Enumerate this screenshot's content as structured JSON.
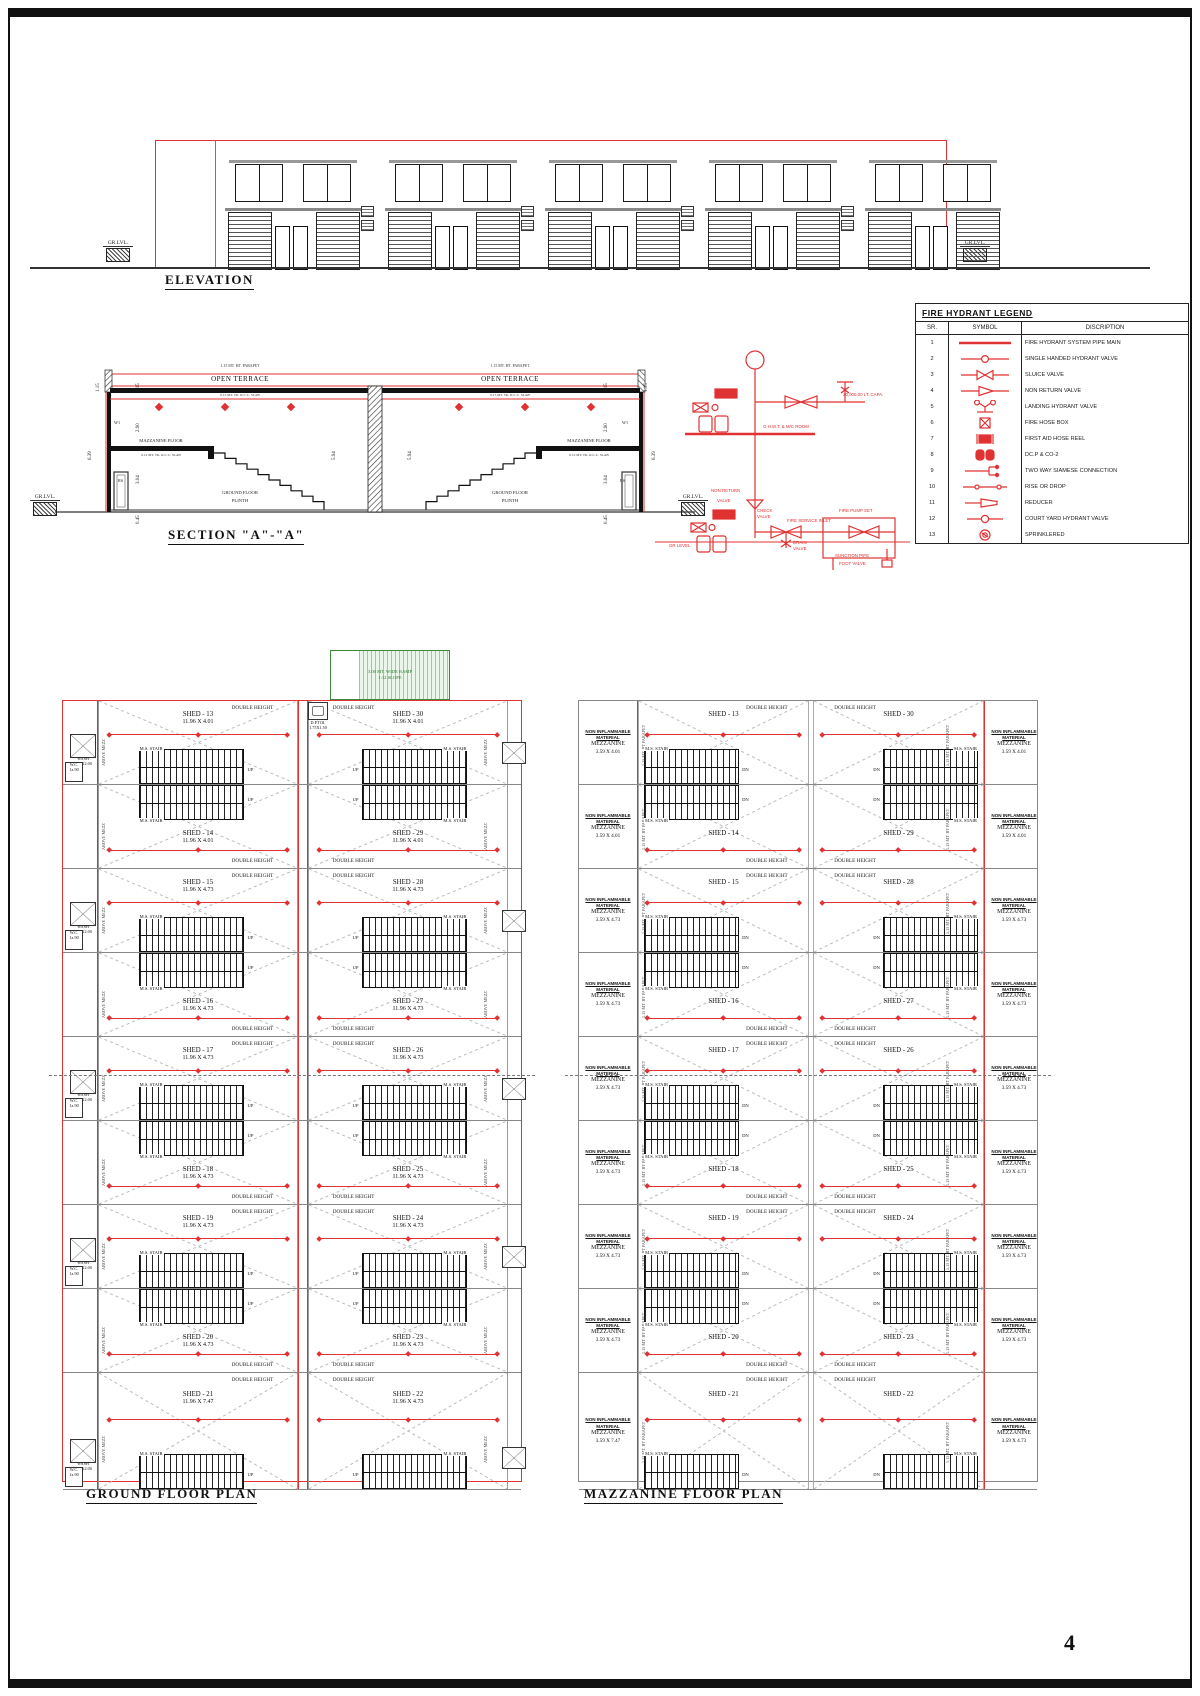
{
  "page": {
    "number": "4"
  },
  "labels": {
    "double_height": "DOUBLE HEIGHT",
    "ms_stair": "M.S. STAIR",
    "up": "UP",
    "dn": "DN",
    "above_mezz": "ABOVE MEZZ",
    "wc": "W.C.\n1x.90",
    "wash": "WASH\n2.00X2.00",
    "parapet_side": "1.15 MT. HT PARAPET",
    "gr_lvl": "GR.LVL."
  },
  "elevation": {
    "title": "ELEVATION",
    "bays": 5
  },
  "section": {
    "title": "SECTION \"A\"-\"A\"",
    "parapet_note": "1.15 MT. HT. PARAPET",
    "open_terrace": "OPEN TERRACE",
    "terrace_slab_note": "0.15 MT. TK. R.C.C. SLAB",
    "mezz_floor": "MAZZANINE FLOOR",
    "mezz_slab_note": "0.12 MT. TK. R.C.C. SLAB",
    "ground_floor": "GROUND FLOOR",
    "plinth": "PLINTH",
    "w1": "W1",
    "rs": "RS",
    "dims": {
      "d115": "1.15",
      "d290": "2.90",
      "d304": "3.04",
      "d594": "5.94",
      "d639": "6.39",
      "d045": "0.45"
    }
  },
  "schematic": {
    "capacity": "20,000.00 LT. CAPA.",
    "ohwt": "O.H.W.T. & M/C ROOM",
    "non_return": "NON RETURN",
    "valve": "VALVE",
    "check_valve": "CHECK\nVALVE",
    "fire_service_inlet": "FIRE SERVICE INLET",
    "drain_valve": "DRAIN\nVALVE",
    "fire_pump_set": "FIRE PUMP SET",
    "gr_level": "GR LEVEL",
    "suction_pipe": "SUNCTION PIPE",
    "foot_valve": "FOOT VALVE"
  },
  "legend": {
    "title": "FIRE HYDRANT LEGEND",
    "headers": [
      "SR.",
      "SYMBOL",
      "DISCRIPTION"
    ],
    "rows": [
      {
        "sr": "1",
        "symbol": "pipe-main",
        "desc": "FIRE HYDRANT SYSTEM PIPE MAIN"
      },
      {
        "sr": "2",
        "symbol": "single-hydrant-valve",
        "desc": "SINGLE HANDED HYDRANT VALVE"
      },
      {
        "sr": "3",
        "symbol": "sluice-valve",
        "desc": "SLUICE VALVE"
      },
      {
        "sr": "4",
        "symbol": "non-return-valve",
        "desc": "NON RETURN VALVE"
      },
      {
        "sr": "5",
        "symbol": "landing-hydrant-valve",
        "desc": "LANDING HYDRANT VALVE"
      },
      {
        "sr": "6",
        "symbol": "fire-hose-box",
        "desc": "FIRE HOSE BOX"
      },
      {
        "sr": "7",
        "symbol": "first-aid-hose-reel",
        "desc": "FIRST AID HOSE REEL"
      },
      {
        "sr": "8",
        "symbol": "dcp-co2",
        "desc": "DC.P & CO-2"
      },
      {
        "sr": "9",
        "symbol": "siamese",
        "desc": "TWO WAY SIAMESE CONNECTION"
      },
      {
        "sr": "10",
        "symbol": "rise-drop",
        "desc": "RISE OR DROP"
      },
      {
        "sr": "11",
        "symbol": "reducer",
        "desc": "REDUCER"
      },
      {
        "sr": "12",
        "symbol": "courtyard-hydrant-valve",
        "desc": "COURT YARD HYDRANT VALVE"
      },
      {
        "sr": "13",
        "symbol": "sprinkler",
        "desc": "SPRINKLERED"
      }
    ]
  },
  "ground_plan": {
    "title": "GROUND FLOOR PLAN",
    "ramp": {
      "line1": "3.00 MT. WIDE RAMP",
      "line2": "1:12 SLOPE"
    },
    "dp_toi": {
      "name": "D.P.TOI.",
      "size": "1.75X1.50"
    },
    "rows": [
      {
        "l_name": "SHED - 13",
        "l_size": "11.96 X 4.01",
        "r_name": "SHED - 30",
        "r_size": "11.96 X 4.01"
      },
      {
        "l_name": "SHED - 14",
        "l_size": "11.96 X 4.01",
        "r_name": "SHED - 29",
        "r_size": "11.96 X 4.01"
      },
      {
        "l_name": "SHED - 15",
        "l_size": "11.96 X 4.73",
        "r_name": "SHED - 28",
        "r_size": "11.96 X 4.73"
      },
      {
        "l_name": "SHED - 16",
        "l_size": "11.96 X 4.73",
        "r_name": "SHED - 27",
        "r_size": "11.96 X 4.73"
      },
      {
        "l_name": "SHED - 17",
        "l_size": "11.96 X 4.73",
        "r_name": "SHED - 26",
        "r_size": "11.96 X 4.73"
      },
      {
        "l_name": "SHED - 18",
        "l_size": "11.96 X 4.73",
        "r_name": "SHED - 25",
        "r_size": "11.96 X 4.73"
      },
      {
        "l_name": "SHED - 19",
        "l_size": "11.96 X 4.73",
        "r_name": "SHED - 24",
        "r_size": "11.96 X 4.73"
      },
      {
        "l_name": "SHED - 20",
        "l_size": "11.96 X 4.73",
        "r_name": "SHED - 23",
        "r_size": "11.96 X 4.73"
      },
      {
        "l_name": "SHED - 21",
        "l_size": "11.96 X 7.47",
        "r_name": "SHED - 22",
        "r_size": "11.96 X 4.73"
      }
    ]
  },
  "mezzanine_plan": {
    "title": "MAZZANINE FLOOR PLAN",
    "material_line1": "NON INFLAMMABLE",
    "material_line2": "MATERIAL",
    "material_line3": "MEZZANINE",
    "rows": [
      {
        "l_shed": "SHED - 13",
        "l_mezz": "3.59 X 4.01",
        "r_shed": "SHED - 30",
        "r_mezz": "3.59 X 4.01"
      },
      {
        "l_shed": "SHED - 14",
        "l_mezz": "3.59 X 4.01",
        "r_shed": "SHED - 29",
        "r_mezz": "3.59 X 4.01"
      },
      {
        "l_shed": "SHED - 15",
        "l_mezz": "3.59 X 4.73",
        "r_shed": "SHED - 28",
        "r_mezz": "3.59 X 4.73"
      },
      {
        "l_shed": "SHED - 16",
        "l_mezz": "3.59 X 4.73",
        "r_shed": "SHED - 27",
        "r_mezz": "3.59 X 4.73"
      },
      {
        "l_shed": "SHED - 17",
        "l_mezz": "3.59 X 4.73",
        "r_shed": "SHED - 26",
        "r_mezz": "3.59 X 4.73"
      },
      {
        "l_shed": "SHED - 18",
        "l_mezz": "3.59 X 4.73",
        "r_shed": "SHED - 25",
        "r_mezz": "3.59 X 4.73"
      },
      {
        "l_shed": "SHED - 19",
        "l_mezz": "3.59 X 4.73",
        "r_shed": "SHED - 24",
        "r_mezz": "3.59 X 4.73"
      },
      {
        "l_shed": "SHED - 20",
        "l_mezz": "3.59 X 4.73",
        "r_shed": "SHED - 23",
        "r_mezz": "3.59 X 4.73"
      },
      {
        "l_shed": "SHED - 21",
        "l_mezz": "3.59 X 7.47",
        "r_shed": "SHED - 22",
        "r_mezz": "3.59 X 4.73"
      }
    ]
  }
}
